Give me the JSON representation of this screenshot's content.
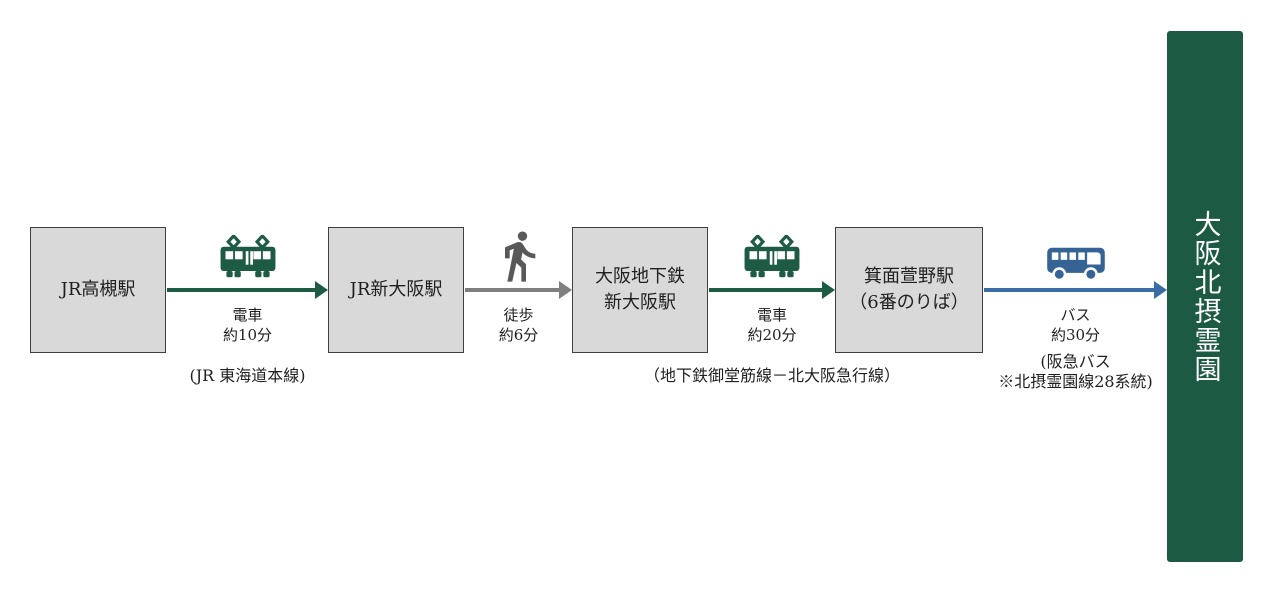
{
  "destination": {
    "name": "大阪北摂霊園"
  },
  "stations": [
    {
      "lines": [
        "JR高槻駅"
      ]
    },
    {
      "lines": [
        "JR新大阪駅"
      ]
    },
    {
      "lines": [
        "大阪地下鉄",
        "新大阪駅"
      ]
    },
    {
      "lines": [
        "箕面萱野駅",
        "（6番のりば）"
      ]
    }
  ],
  "segments": [
    {
      "icon": "train-icon",
      "label": "電車",
      "duration": "約10分",
      "note1": "(JR 東海道本線)",
      "note2": "",
      "color": "#1e5b45"
    },
    {
      "icon": "walk-icon",
      "label": "徒歩",
      "duration": "約6分",
      "note1": "",
      "note2": "",
      "color": "#7f7f7f"
    },
    {
      "icon": "train-icon",
      "label": "電車",
      "duration": "約20分",
      "note1": "（地下鉄御堂筋線－北大阪急行線）",
      "note2": "",
      "color": "#1e5b45"
    },
    {
      "icon": "bus-icon",
      "label": "バス",
      "duration": "約30分",
      "note1": "(阪急バス",
      "note2": "※北摂霊園線28系統)",
      "color": "#3a6ca6"
    }
  ],
  "colors": {
    "train_green": "#1e5b45",
    "walk_gray": "#7f7f7f",
    "bus_blue": "#3a6ca6",
    "station_box_fill": "#d9d9d9",
    "destination_banner": "#1d5a44"
  }
}
